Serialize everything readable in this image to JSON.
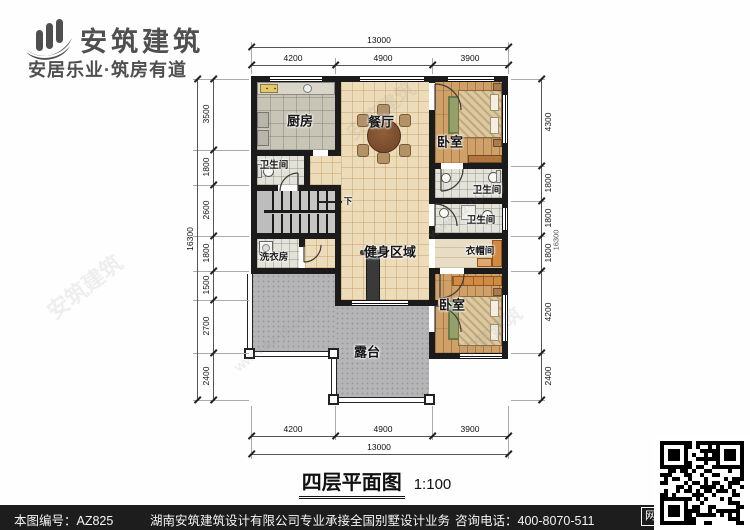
{
  "brand": {
    "name": "安筑建筑",
    "tagline": "安居乐业·筑房有道"
  },
  "plan": {
    "rooms": {
      "kitchen": "厨房",
      "dining": "餐厅",
      "bedroom_top": "卧室",
      "bath_left": "卫生间",
      "bath_right_1": "卫生间",
      "bath_right_2": "卫生间",
      "laundry": "洗衣房",
      "gym": "健身区域",
      "cloakroom": "衣帽间",
      "bedroom_bottom": "卧室",
      "terrace": "露台",
      "stairs_down": "下"
    }
  },
  "dims": {
    "top": {
      "total": "13000",
      "segments": [
        "4200",
        "4900",
        "3900"
      ]
    },
    "bottom": {
      "total": "13000",
      "segments": [
        "4200",
        "4900",
        "3900"
      ]
    },
    "left": {
      "total": "16300",
      "segments": [
        "3500",
        "1800",
        "2600",
        "1800",
        "1500",
        "2700",
        "2400"
      ]
    },
    "right": {
      "total": "16300",
      "segments": [
        "4300",
        "1800",
        "1800",
        "1800",
        "4200",
        "2400"
      ]
    }
  },
  "title": {
    "name": "四层平面图",
    "scale": "1:100"
  },
  "watermark": {
    "brand": "安筑建筑",
    "site": "www.az-jz.com"
  },
  "footer": {
    "sheet_no": "本图编号：AZ825",
    "company": "湖南安筑建筑设计有限公司",
    "service": "专业承接全国别墅设计业务",
    "phone": "咨询电话：400-8070-511",
    "web_badge": "网"
  },
  "colors": {
    "wall": "#1b1b1b",
    "tile_warm": "#eddcba",
    "tile_kitchen": "#c9c5b6",
    "wood": "#cfa068",
    "terrace": "#b5b5b7",
    "accent_wardrobe": "#d28a42"
  }
}
